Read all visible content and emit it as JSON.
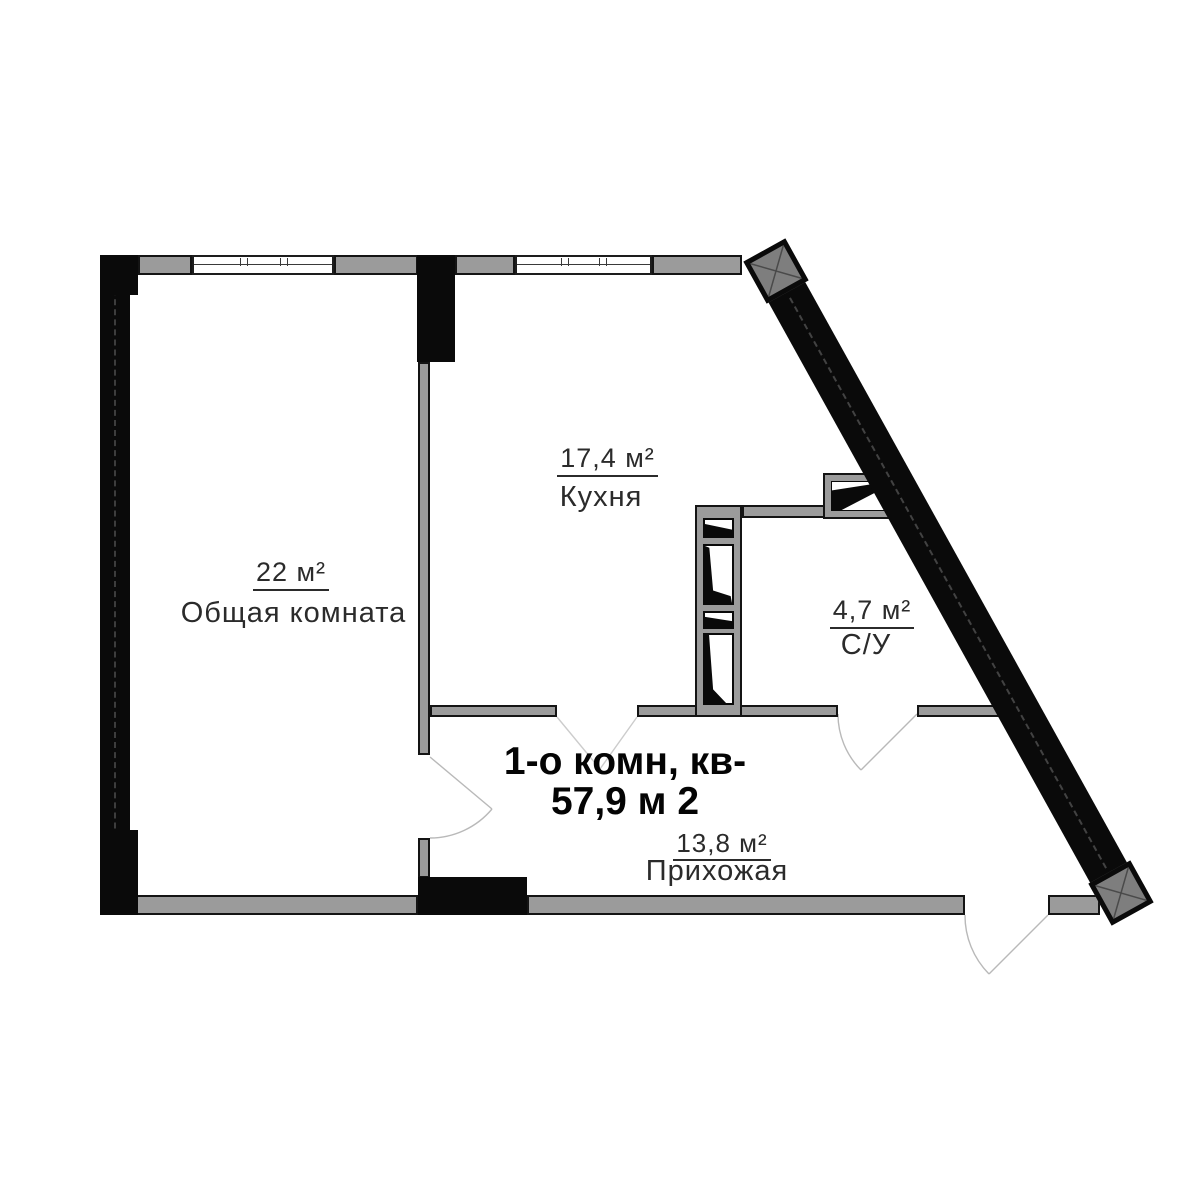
{
  "plan": {
    "apartment": {
      "line1": "1-о комн, кв-",
      "line2": "57,9 м 2"
    },
    "rooms": [
      {
        "area": "22 м²",
        "name": "Общая комната"
      },
      {
        "area": "17,4 м²",
        "name": "Кухня"
      },
      {
        "area": "4,7 м²",
        "name": "С/У"
      },
      {
        "area": "13,8 м²",
        "name": "Прихожая"
      }
    ],
    "colors": {
      "wall_black": "#0a0a0a",
      "wall_gray": "#9b9b9b",
      "corner_square_gray": "#7e7e7e",
      "label_text": "#2b2b2b",
      "door_line": "#b9b9b9"
    }
  }
}
